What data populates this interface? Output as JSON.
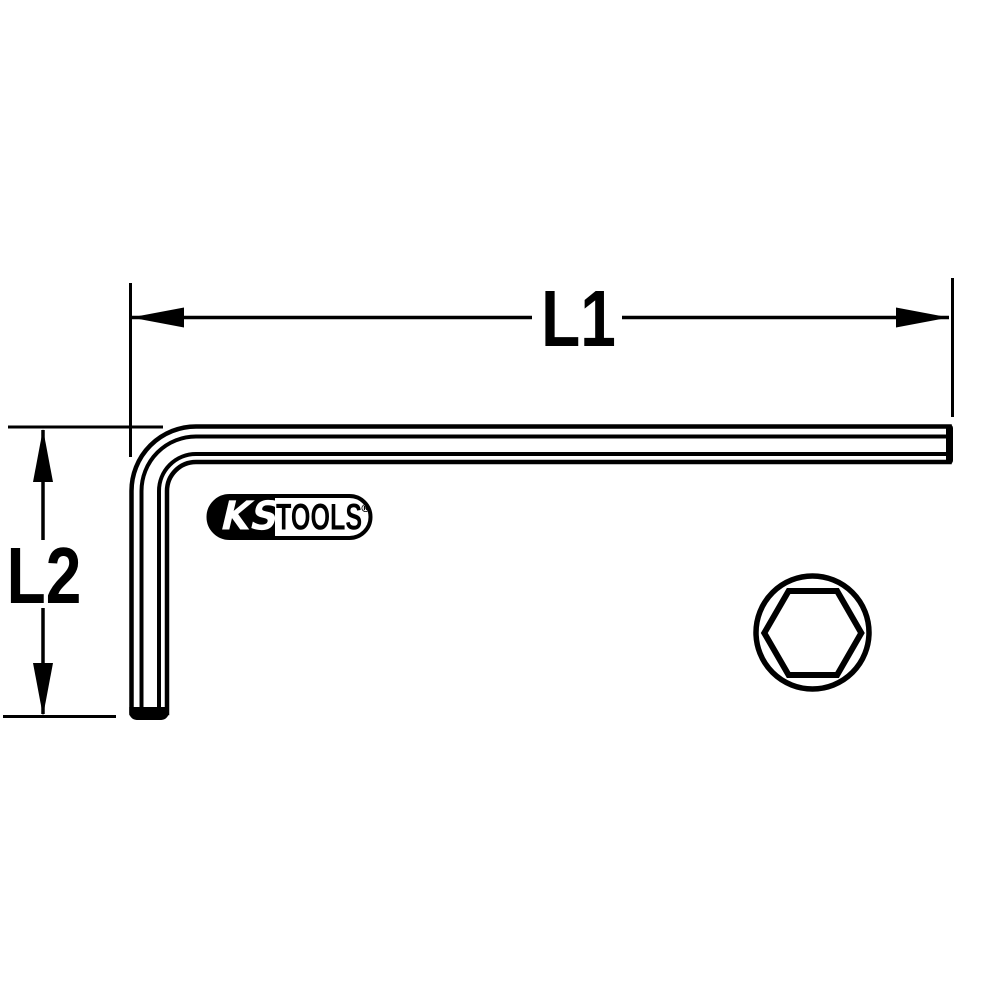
{
  "drawing": {
    "kind": "hex-key-technical-drawing",
    "dimensions": {
      "l1_label": "L1",
      "l2_label": "L2"
    },
    "logo": {
      "left_text": "KS",
      "right_text": "TOOLS",
      "registered_mark": "®"
    },
    "colors": {
      "line": "#000000",
      "background": "#ffffff",
      "logo_left_bg": "#000000",
      "logo_left_text": "#ffffff"
    }
  }
}
